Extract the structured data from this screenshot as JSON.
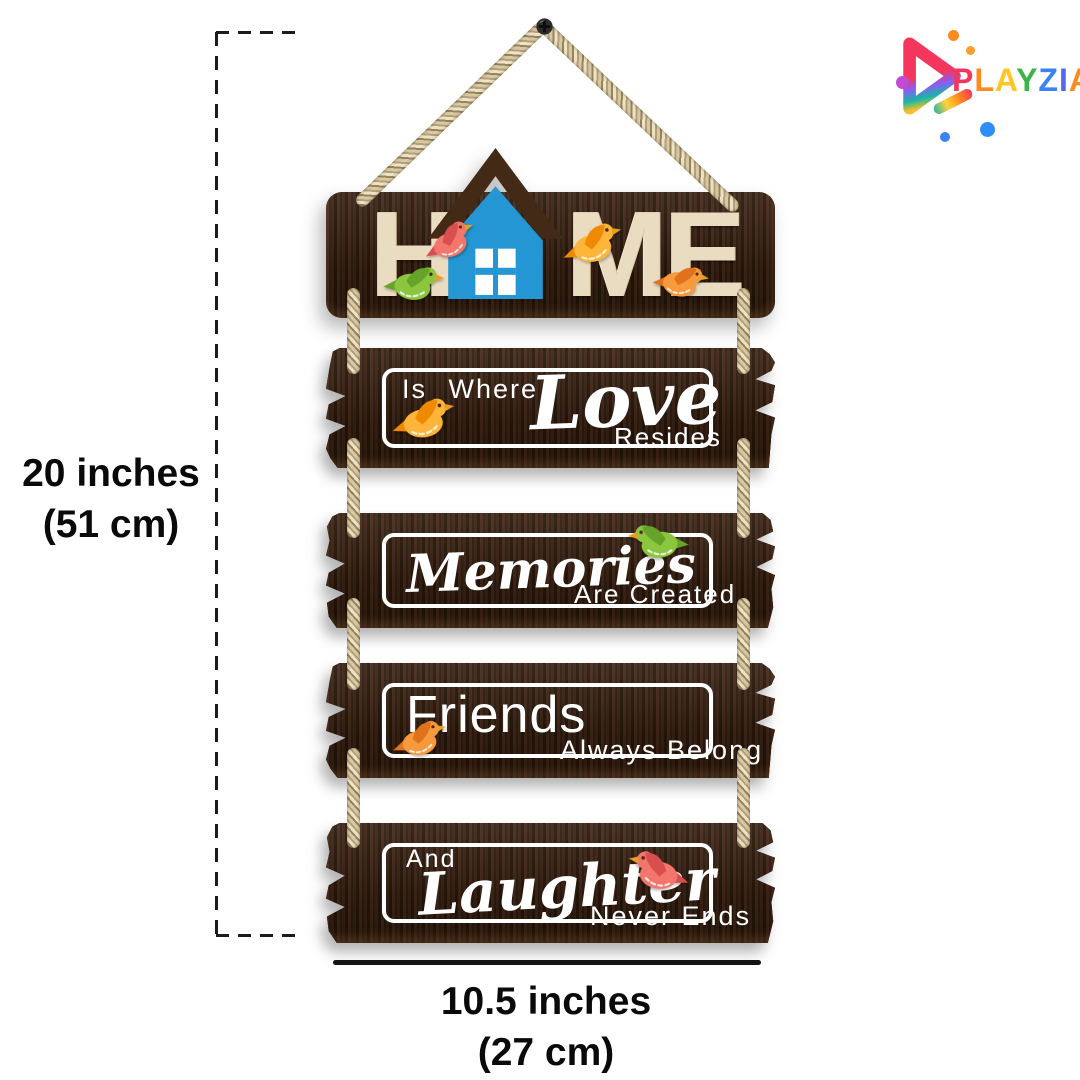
{
  "page": {
    "background": "#ffffff"
  },
  "brand": {
    "name": "PLAYZIA",
    "letters": [
      {
        "ch": "P",
        "color": "#f5365c"
      },
      {
        "ch": "L",
        "color": "#ff8a1e"
      },
      {
        "ch": "A",
        "color": "#ffc626"
      },
      {
        "ch": "Y",
        "color": "#3cb44a"
      },
      {
        "ch": "Z",
        "color": "#3b82f6"
      },
      {
        "ch": "I",
        "color": "#5468f0"
      },
      {
        "ch": "A",
        "color": "#ff8a1e"
      }
    ],
    "triangle_colors": [
      "#f5365c",
      "#8b5cf6",
      "#14b8a6",
      "#fbbf24"
    ]
  },
  "dimensions": {
    "height": {
      "line1": "20 inches",
      "line2": "(51 cm)"
    },
    "width": {
      "line1": "10.5 inches",
      "line2": "(27 cm)"
    }
  },
  "product": {
    "board_color": "#3a2315",
    "board_letter_color": "#e9dcc0",
    "rope_color": "#cfc09a",
    "house": {
      "wall": "#2496d3",
      "roof": "#432a16",
      "window": "#ffffff"
    },
    "planks": [
      {
        "name": "home",
        "letters": [
          "H",
          "M",
          "E"
        ]
      },
      {
        "name": "love",
        "lead": "Is Where",
        "script": "Love",
        "trail": "Resides"
      },
      {
        "name": "memories",
        "script": "Memories",
        "trail": "Are Created"
      },
      {
        "name": "friends",
        "lead": "Friends",
        "trail": "Always Belong"
      },
      {
        "name": "laughter",
        "lead": "And",
        "script": "Laughter",
        "trail": "Never Ends"
      }
    ]
  },
  "birds": [
    {
      "location": "home-near-h",
      "body": "#f2766b",
      "wing": "#d94f4f"
    },
    {
      "location": "home-lower-left",
      "body": "#8cc63f",
      "wing": "#66a32a"
    },
    {
      "location": "home-near-m",
      "body": "#ffb53a",
      "wing": "#ef8a00"
    },
    {
      "location": "home-near-e",
      "body": "#f79a3e",
      "wing": "#e0711d"
    },
    {
      "location": "love-plank",
      "body": "#ffb53a",
      "wing": "#ef8a00"
    },
    {
      "location": "memories-plank",
      "body": "#8cc63f",
      "wing": "#66a32a"
    },
    {
      "location": "friends-plank",
      "body": "#f79a3e",
      "wing": "#e0711d"
    },
    {
      "location": "laughter-plank",
      "body": "#f2766b",
      "wing": "#d94f4f"
    }
  ],
  "icons": {
    "logo": "play-triangle-icon",
    "nail": "nail-icon",
    "house": "house-icon",
    "bird": "bird-icon"
  }
}
